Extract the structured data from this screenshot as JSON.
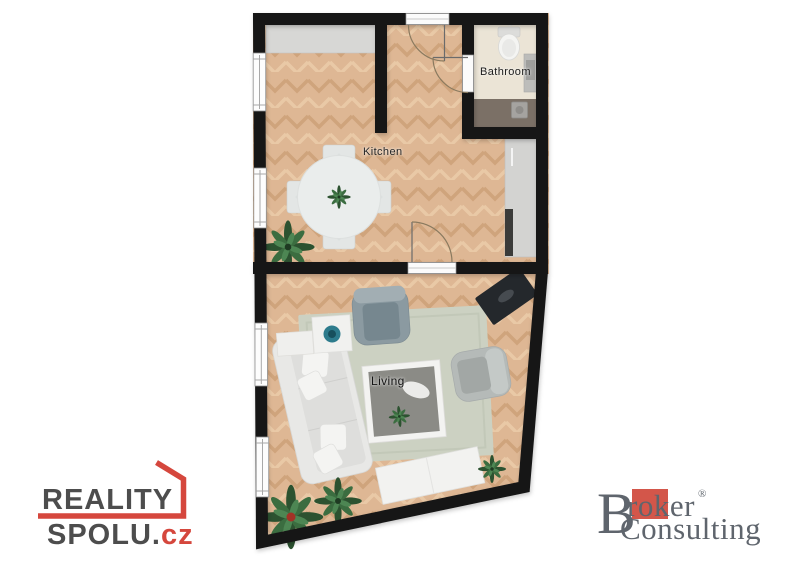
{
  "app": {
    "type": "floorplan-render",
    "background": "#ffffff"
  },
  "floorplan": {
    "rooms": {
      "kitchen": {
        "label": "Kitchen"
      },
      "bathroom": {
        "label": "Bathroom"
      },
      "living": {
        "label": "Living"
      }
    },
    "palette": {
      "wall": "#161616",
      "wood_floor": "#deb794",
      "bathroom_floor": "#ebe4d6",
      "bathroom_wet_zone": "#7b7066",
      "rug": "#ccd1c2",
      "plant_green": "#2c5230"
    }
  },
  "branding": {
    "reality_spolu": {
      "line1": "REALITY",
      "line2_main": "SPOLU.",
      "line2_suffix": "cz",
      "accent_color": "#d5473d",
      "text_color": "#4d4d4d"
    },
    "broker_consulting": {
      "initial": "B",
      "word1_rest": "roker",
      "registered_mark": "®",
      "word2": "Consulting",
      "accent_color": "#d3564a",
      "text_color": "#5f656d"
    }
  }
}
